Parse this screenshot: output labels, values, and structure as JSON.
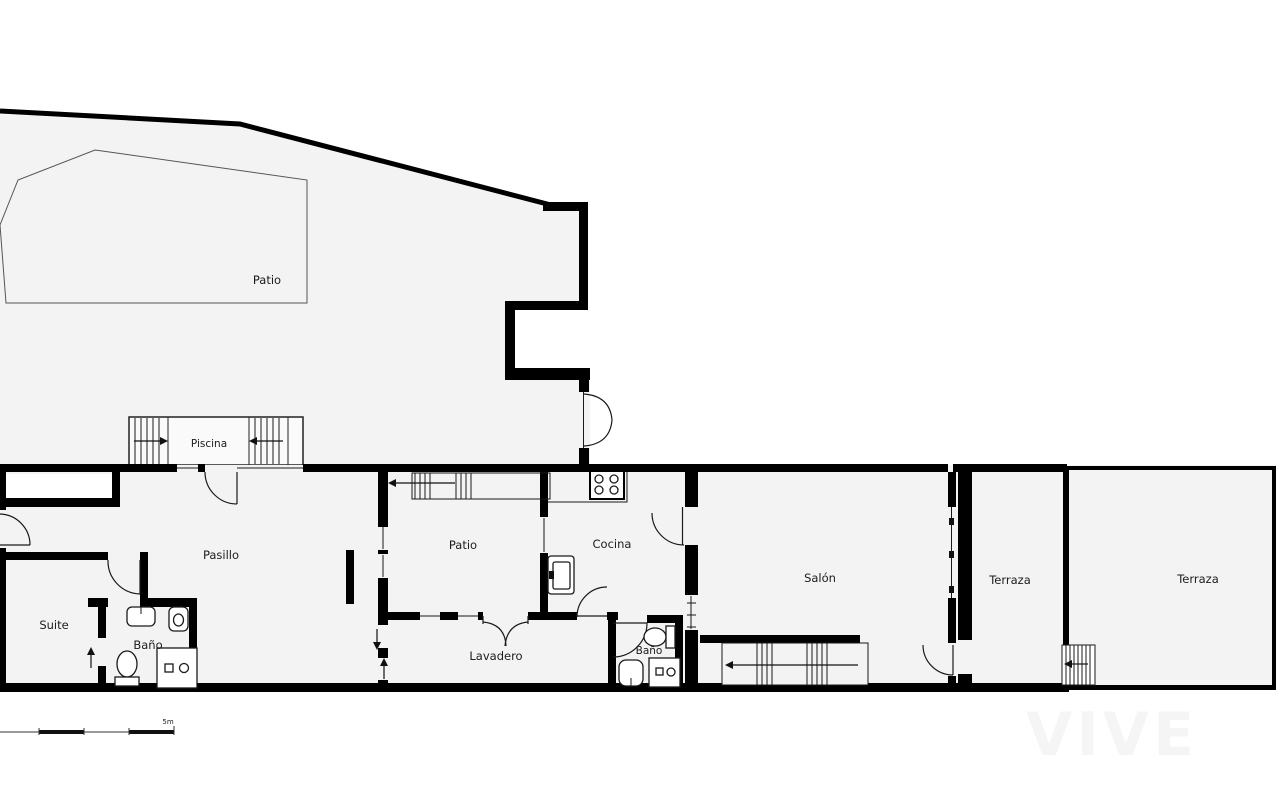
{
  "plan": {
    "rooms": {
      "patio_top": "Patio",
      "piscina": "Piscina",
      "pasillo": "Pasillo",
      "suite": "Suite",
      "bano_1": "Baño",
      "patio_interior": "Patio",
      "cocina": "Cocina",
      "lavadero": "Lavadero",
      "bano_2": "Baño",
      "salon": "Salón",
      "terraza_1": "Terraza",
      "terraza_2": "Terraza"
    },
    "scale_label": "5m",
    "watermark": "VIVE",
    "colors": {
      "wall": "#000000",
      "floor": "#f3f3f3",
      "line": "#1a1a1a",
      "background": "#ffffff"
    }
  }
}
